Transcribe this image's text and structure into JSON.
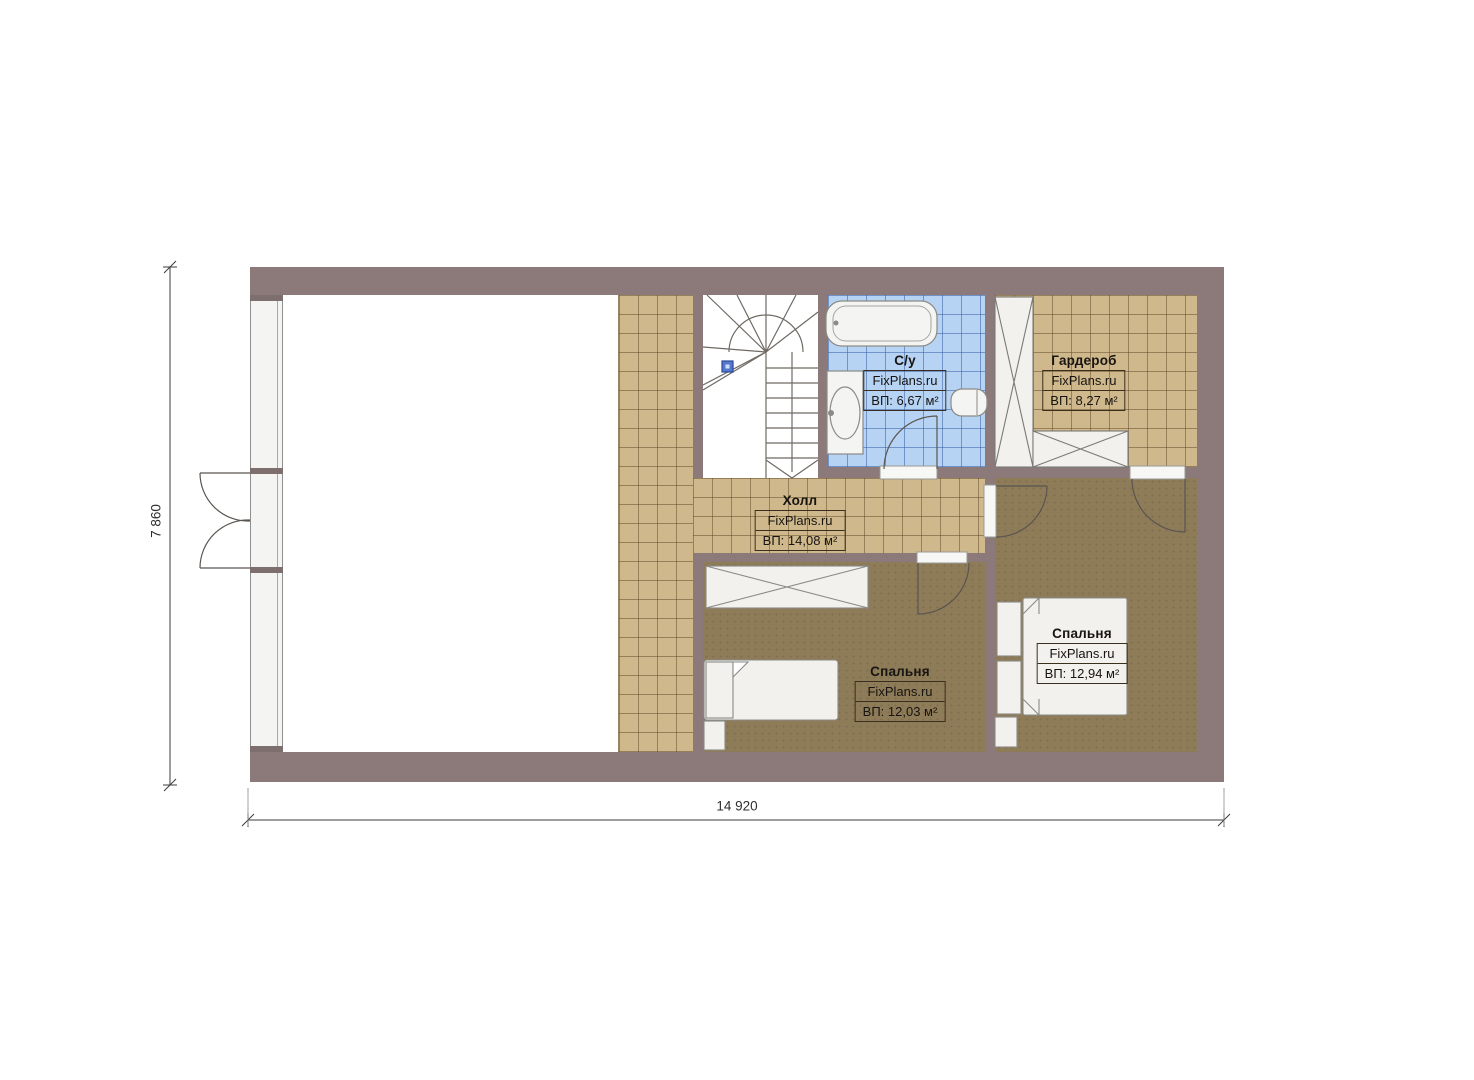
{
  "plan": {
    "dim_width_label": "14 920",
    "dim_height_label": "7 860",
    "rooms": [
      {
        "key": "bathroom",
        "name": "С/у",
        "watermark": "FixPlans.ru",
        "area": "ВП: 6,67 м²"
      },
      {
        "key": "wardrobe",
        "name": "Гардероб",
        "watermark": "FixPlans.ru",
        "area": "ВП: 8,27 м²"
      },
      {
        "key": "hall",
        "name": "Холл",
        "watermark": "FixPlans.ru",
        "area": "ВП: 14,08 м²"
      },
      {
        "key": "bedroom_small",
        "name": "Спальня",
        "watermark": "FixPlans.ru",
        "area": "ВП: 12,03 м²"
      },
      {
        "key": "bedroom_large",
        "name": "Спальня",
        "watermark": "FixPlans.ru",
        "area": "ВП: 12,94 м²"
      }
    ],
    "colors": {
      "wall": "#8c7a7a",
      "tile_tan": "#cfb98c",
      "tile_blue": "#b7d3f3",
      "floor_brown": "#8e7b58",
      "marker_blue": "#5577cc"
    }
  }
}
